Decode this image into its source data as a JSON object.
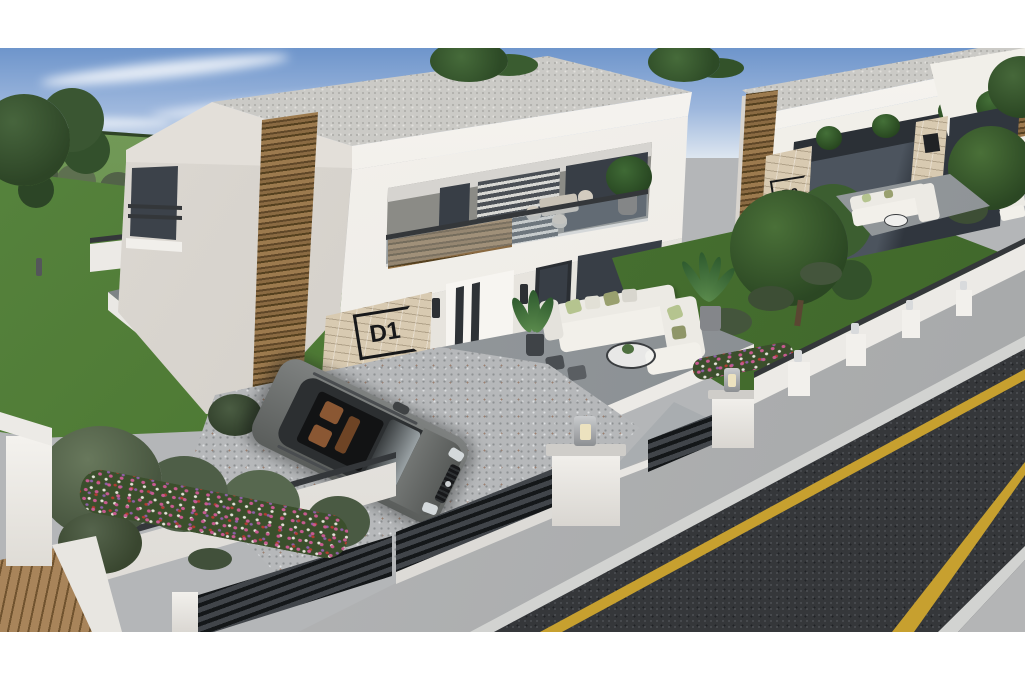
{
  "scene": {
    "type": "architectural-exterior-3d-render",
    "description": "Elevated three-quarter 3D rendering of a row of modern two-storey white villas with wood-slat accents, stone-clad entry columns, balconies with dining sets, garden terraces with white lounge sofas, a gravel driveway with a parked grey SUV, white perimeter fencing with dark slat panels and lamp pillars, lawns, hedges, flower beds, a wooden deck and an asphalt street with yellow edge lines.",
    "villas": [
      {
        "name": "villa-d1",
        "plaque_label": "D1"
      },
      {
        "name": "villa-d2",
        "plaque_label": "D2"
      },
      {
        "name": "villa-d3",
        "plaque_label": ""
      }
    ],
    "objects": [
      "grey-suv",
      "patio-sofa-set",
      "balcony-dining-set",
      "garden-dining-set",
      "potted-plants",
      "lamp-pillars",
      "gravel-driveway",
      "asphalt-road",
      "wooden-deck",
      "flower-beds",
      "hedges",
      "trees"
    ],
    "colors": {
      "sky_top": "#6e95cb",
      "sky_horizon": "#e6ecf3",
      "field_green": "#5d8c46",
      "lawn_green": "#4e7b38",
      "tree_green": "#3c5a33",
      "hedge_green": "#5a6a52",
      "wall_white": "#f4f2ee",
      "wall_shadow": "#d8d5d0",
      "roof_gravel": "#cbcac6",
      "wood_slat": "#8a6a42",
      "stone_clad": "#d8cab1",
      "glass_dark": "#3a4046",
      "concrete": "#9aa0a3",
      "gravel": "#b6b8ba",
      "fence_dark": "#2f3336",
      "car_grey": "#64676a",
      "car_interior_brown": "#8a5733",
      "asphalt": "#36383b",
      "road_line_yellow": "#c7a02f",
      "curb": "#d2d3d1",
      "flower_pink": "#c85a90",
      "letterbox": "#ffffff"
    }
  }
}
